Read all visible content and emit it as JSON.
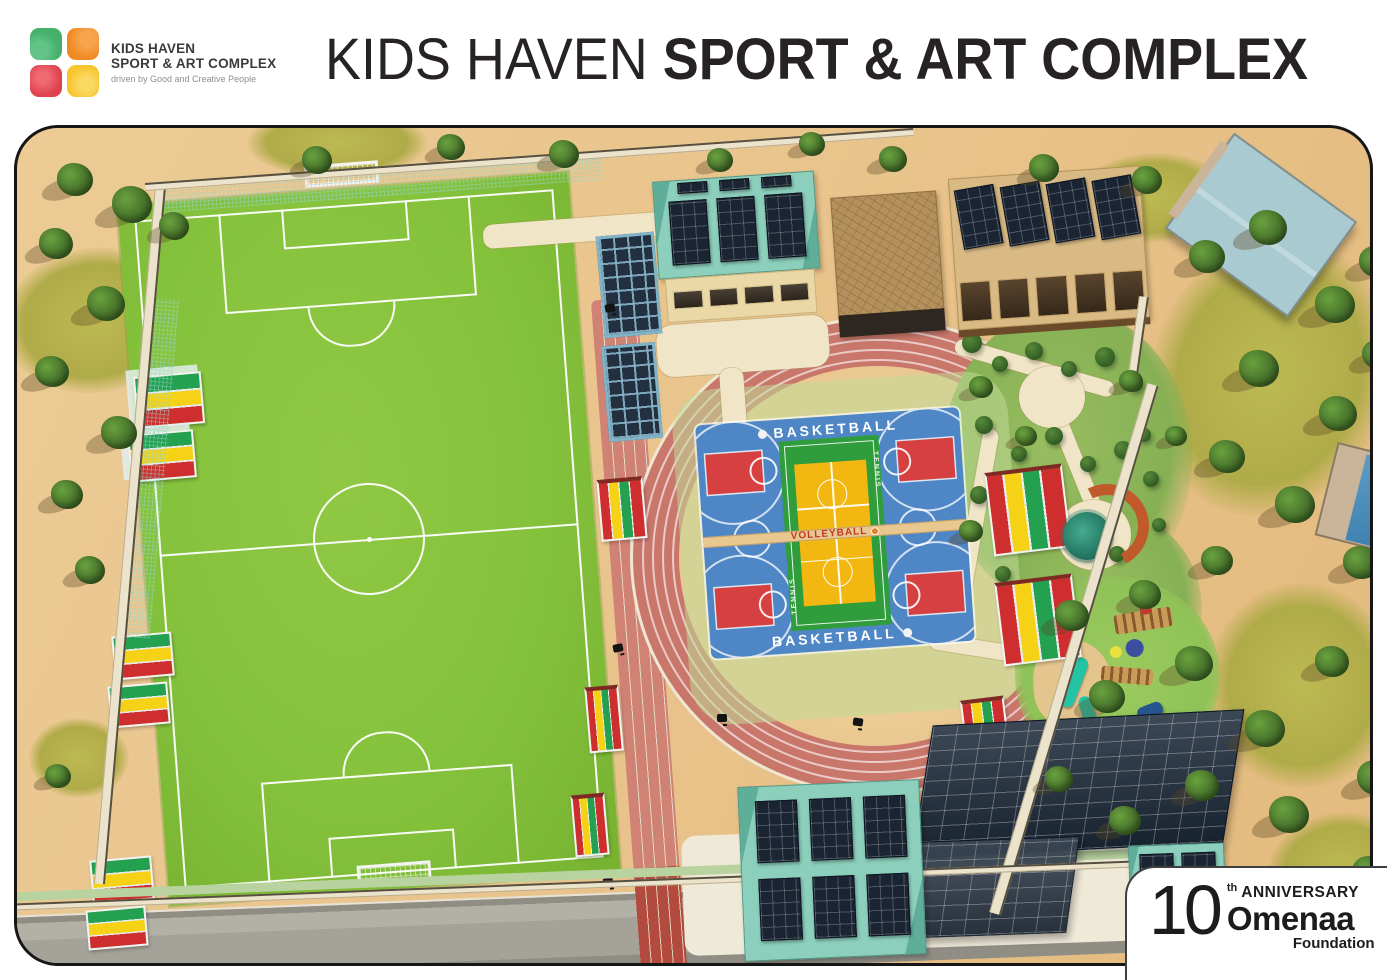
{
  "header": {
    "logo": {
      "line1": "KIDS HAVEN",
      "line2": "SPORT & ART COMPLEX",
      "tagline": "driven by Good and Creative People",
      "tile_colors": {
        "green": "#45b06a",
        "orange": "#f18a23",
        "red": "#e0414f",
        "yellow": "#f7c52e"
      }
    },
    "title": {
      "regular": "KIDS HAVEN",
      "bold": "SPORT & ART COMPLEX"
    }
  },
  "site": {
    "court_labels": {
      "basketball_top": "BASKETBALL",
      "basketball_bottom": "BASKETBALL",
      "volleyball": "VOLLEYBALL",
      "tennis_upper": "TENNIS",
      "tennis_lower": "TENNIS"
    },
    "palette": {
      "sand": "#eccb95",
      "pitch_green": "#85c23c",
      "track_red": "#c9776b",
      "court_blue": "#4e86c6",
      "key_red": "#d64040",
      "multi_green": "#2f9d3c",
      "volleyball_yellow": "#f3b711",
      "roof_teal": "#8ccfbc",
      "solar_panel": "#1a2433",
      "bleacher_green": "#23a050",
      "bleacher_yellow": "#f5d216",
      "bleacher_red": "#cf2e2e"
    }
  },
  "badge": {
    "number": "10",
    "suffix": "th",
    "anniversary": "ANNIVERSARY",
    "org": "Omenaa",
    "org_sub": "Foundation"
  }
}
